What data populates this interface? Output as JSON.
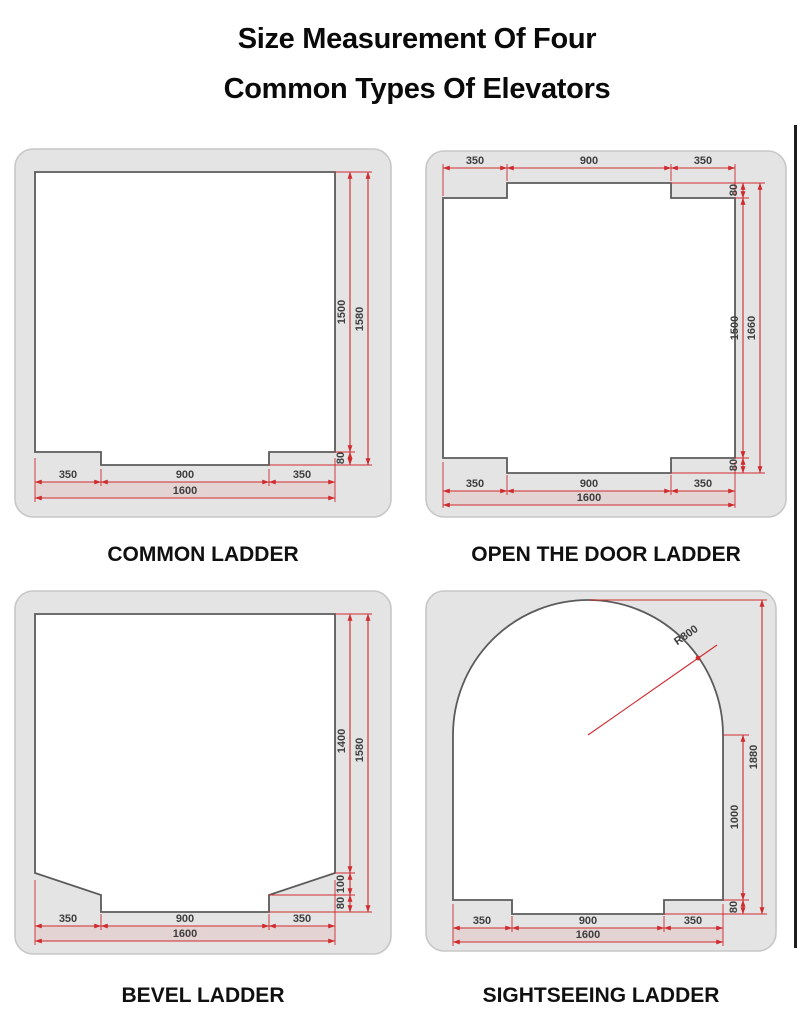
{
  "title": {
    "line1": "Size Measurement Of Four",
    "line2": "Common Types Of Elevators"
  },
  "colors": {
    "dimension_red": "#cf2b2f",
    "panel_gray": "#e4e4e4",
    "shape_outline": "#5b5b5b",
    "text_dark": "#101010"
  },
  "panels": {
    "common": {
      "caption": "COMMON LADDER",
      "dims": {
        "bottom_left": "350",
        "bottom_center": "900",
        "bottom_right": "350",
        "bottom_total": "1600",
        "side_inner": "1500",
        "side_total": "1580",
        "door_depth": "80"
      }
    },
    "open_door": {
      "caption": "OPEN THE DOOR LADDER",
      "dims": {
        "top_left": "350",
        "top_center": "900",
        "top_right": "350",
        "top_door_depth": "80",
        "bottom_left": "350",
        "bottom_center": "900",
        "bottom_right": "350",
        "bottom_total": "1600",
        "side_inner": "1500",
        "side_total": "1660",
        "bottom_door_depth": "80"
      }
    },
    "bevel": {
      "caption": "BEVEL LADDER",
      "dims": {
        "bottom_left": "350",
        "bottom_center": "900",
        "bottom_right": "350",
        "bottom_total": "1600",
        "side_inner": "1400",
        "side_total": "1580",
        "bevel_depth": "100",
        "door_depth": "80"
      }
    },
    "sightseeing": {
      "caption": "SIGHTSEEING LADDER",
      "dims": {
        "radius": "R800",
        "side_total": "1880",
        "side_wall": "1000",
        "door_depth": "80",
        "bottom_left": "350",
        "bottom_center": "900",
        "bottom_right": "350",
        "bottom_total": "1600"
      }
    }
  }
}
